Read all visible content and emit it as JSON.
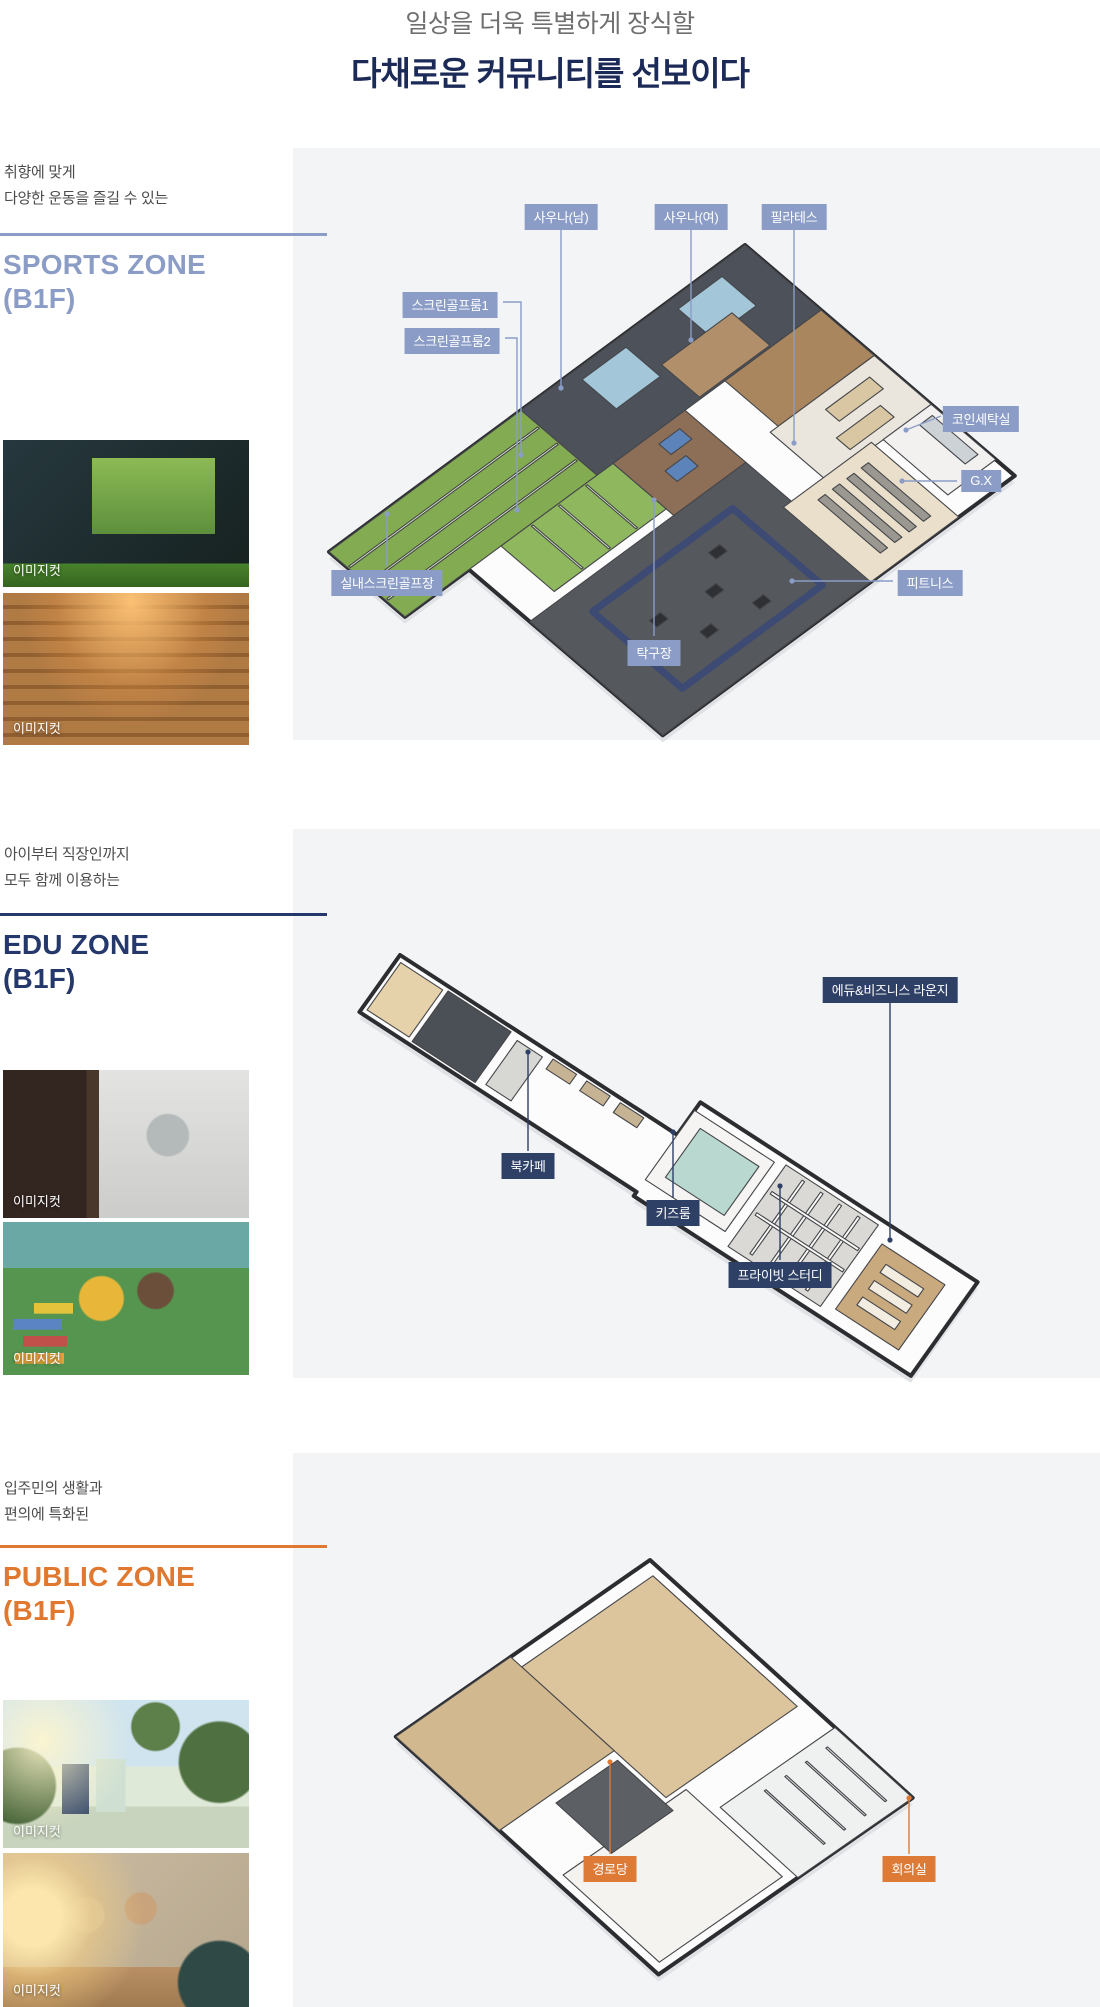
{
  "header": {
    "subtitle": "일상을 더욱 특별하게 장식할",
    "title": "다채로운 커뮤니티를 선보이다"
  },
  "accents": {
    "sports": "#8b9dc7",
    "edu": "#2f4066",
    "public": "#dd7b36"
  },
  "sections": [
    {
      "desc1": "취향에 맞게",
      "desc2": "다양한 운동을 즐길 수 있는",
      "zone": "SPORTS ZONE",
      "floor": "(B1F)",
      "labels": [
        "사우나(남)",
        "사우나(여)",
        "필라테스",
        "스크린골프룸1",
        "스크린골프룸2",
        "코인세탁실",
        "G.X",
        "실내스크린골프장",
        "피트니스",
        "탁구장"
      ],
      "images": [
        {
          "caption": "이미지컷"
        },
        {
          "caption": "이미지컷"
        }
      ]
    },
    {
      "desc1": "아이부터 직장인까지",
      "desc2": "모두 함께 이용하는",
      "zone": "EDU ZONE",
      "floor": "(B1F)",
      "labels": [
        "에듀&비즈니스 라운지",
        "북카페",
        "키즈룸",
        "프라이빗 스터디"
      ],
      "images": [
        {
          "caption": "이미지컷"
        },
        {
          "caption": "이미지컷"
        }
      ]
    },
    {
      "desc1": "입주민의 생활과",
      "desc2": "편의에 특화된",
      "zone": "PUBLIC ZONE",
      "floor": "(B1F)",
      "labels": [
        "경로당",
        "회의실"
      ],
      "images": [
        {
          "caption": "이미지컷"
        },
        {
          "caption": "이미지컷"
        }
      ]
    }
  ]
}
